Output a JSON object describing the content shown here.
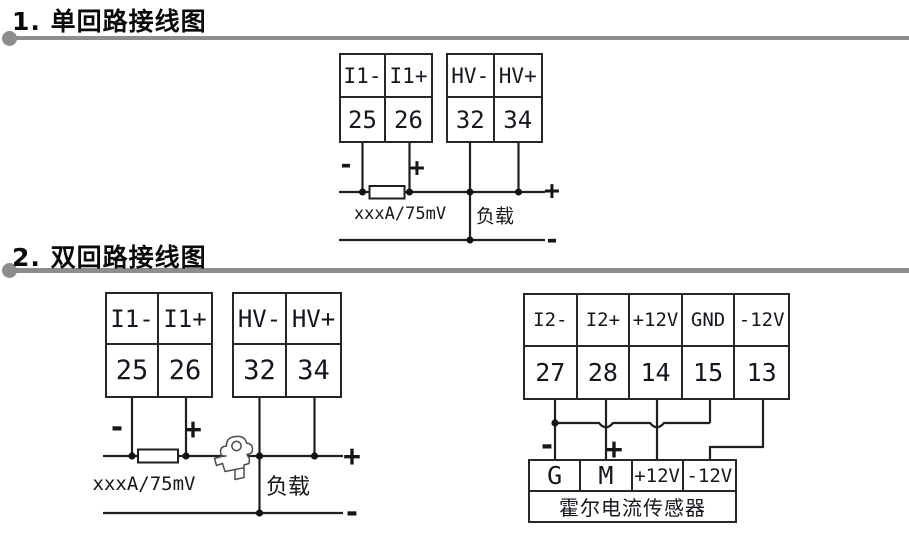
{
  "theme": {
    "background": "#ffffff",
    "wire_color": "#1f1f1f",
    "block_border_color": "#262626",
    "section_rule_color": "#8d8d8d",
    "text_color": "#111111"
  },
  "section1": {
    "title": "1. 单回路接线图",
    "terminal_block_i1": {
      "labels": [
        "I1-",
        "I1+"
      ],
      "terminals": [
        "25",
        "26"
      ]
    },
    "terminal_block_hv": {
      "labels": [
        "HV-",
        "HV+"
      ],
      "terminals": [
        "32",
        "34"
      ]
    },
    "wiring_labels": {
      "input_minus": "-",
      "input_plus": "+",
      "shunt": "xxxA/75mV",
      "load": "负载",
      "output_plus": "+",
      "output_minus": "-"
    }
  },
  "section2": {
    "title": "2. 双回路接线图",
    "terminal_block_i1": {
      "labels": [
        "I1-",
        "I1+"
      ],
      "terminals": [
        "25",
        "26"
      ]
    },
    "terminal_block_hv": {
      "labels": [
        "HV-",
        "HV+"
      ],
      "terminals": [
        "32",
        "34"
      ]
    },
    "terminal_block_i2": {
      "labels": [
        "I2-",
        "I2+",
        "+12V",
        "GND",
        "-12V"
      ],
      "terminals": [
        "27",
        "28",
        "14",
        "15",
        "13"
      ]
    },
    "hall_sensor_block": {
      "pins": [
        "G",
        "M",
        "+12V",
        "-12V"
      ],
      "caption": "霍尔电流传感器"
    },
    "wiring_labels": {
      "input_minus": "-",
      "input_plus": "+",
      "shunt": "xxxA/75mV",
      "load": "负载",
      "output_plus": "+",
      "output_minus": "-",
      "hall_minus": "-",
      "hall_plus": "+"
    }
  },
  "icons": {
    "hall_clamp": "clamp-sensor-icon",
    "shunt_resistor": "resistor-icon",
    "junction": "junction-dot-icon"
  }
}
